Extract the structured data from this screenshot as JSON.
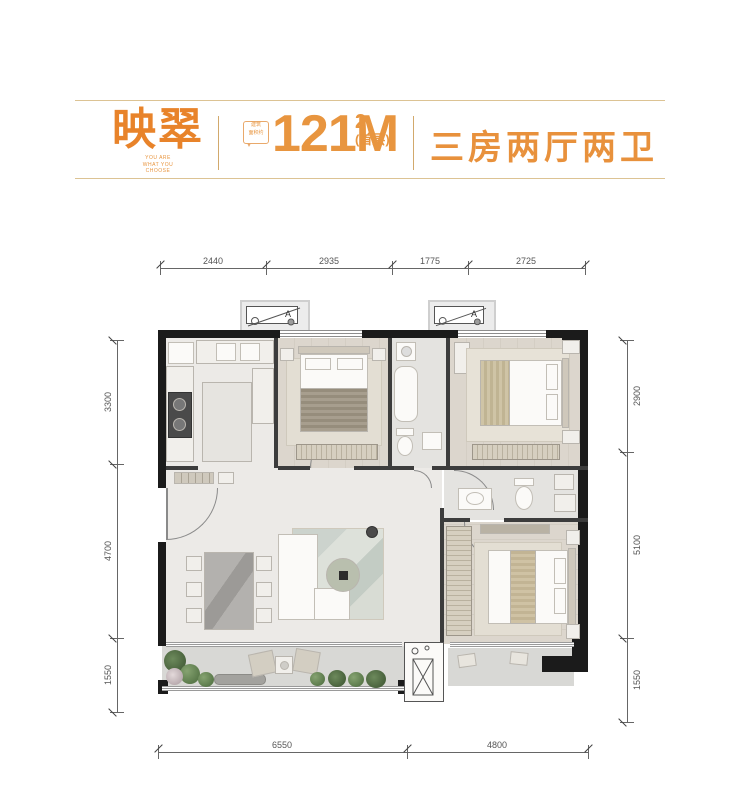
{
  "header": {
    "brand": "映翠",
    "tagline": "YOU ARE\nWHAT YOU\nCHOOSE",
    "area_badge": "建筑\n面积约",
    "area_value": "121M",
    "area_sup": "2",
    "area_note": "(首层)",
    "layout_label": "三房两厅两卫"
  },
  "dims": {
    "top": [
      "2440",
      "2935",
      "1775",
      "2725"
    ],
    "left": [
      "3300",
      "4700",
      "1550"
    ],
    "right": [
      "2900",
      "5100",
      "1550"
    ],
    "bottom": [
      "6550",
      "4800"
    ]
  },
  "ac": {
    "label": "A"
  },
  "colors": {
    "accent": "#E8832A",
    "header_rule": "#DCC394",
    "wall": "#1B1B1B",
    "dim_text": "#555555",
    "plant_green": "#5B7A4B"
  }
}
